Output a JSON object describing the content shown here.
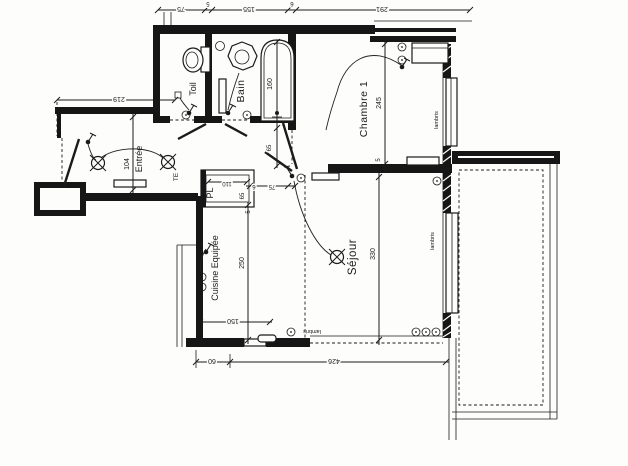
{
  "rooms": {
    "toil": {
      "label": "Toil"
    },
    "bain": {
      "label": "Bain"
    },
    "entree": {
      "label": "Entrée"
    },
    "chambre": {
      "label": "Chambre 1"
    },
    "sejour": {
      "label": "Séjour"
    },
    "cuisine": {
      "label": "Cuisine Equipée"
    },
    "placard": {
      "label": "PL"
    },
    "tableau": {
      "label": "TE"
    }
  },
  "finishes": {
    "lambris": "lambris"
  },
  "dimensions": {
    "top_75": "75",
    "top_5": "5",
    "top_155": "155",
    "top_6": "6",
    "top_291": "291",
    "left_219": "219",
    "entree_104": "104",
    "bain_160": "160",
    "bain_65": "65",
    "chambre_245": "245",
    "chambre_5": "5",
    "pl_110": "110",
    "pl_65": "65",
    "pl_5": "5",
    "door_6": "6",
    "door_75": "75",
    "cuisine_250": "250",
    "cuisine_150": "150",
    "sejour_330": "330",
    "bottom_60": "60",
    "bottom_426": "426"
  },
  "symbols": {
    "ceiling_light": "circle-with-x-cross",
    "switch": "filled-dot-with-tail",
    "socket": "small-circle-with-dot",
    "junction_box": "small-square"
  },
  "colors": {
    "ink": "#1b1b1b",
    "paper": "#fdfdfc"
  }
}
